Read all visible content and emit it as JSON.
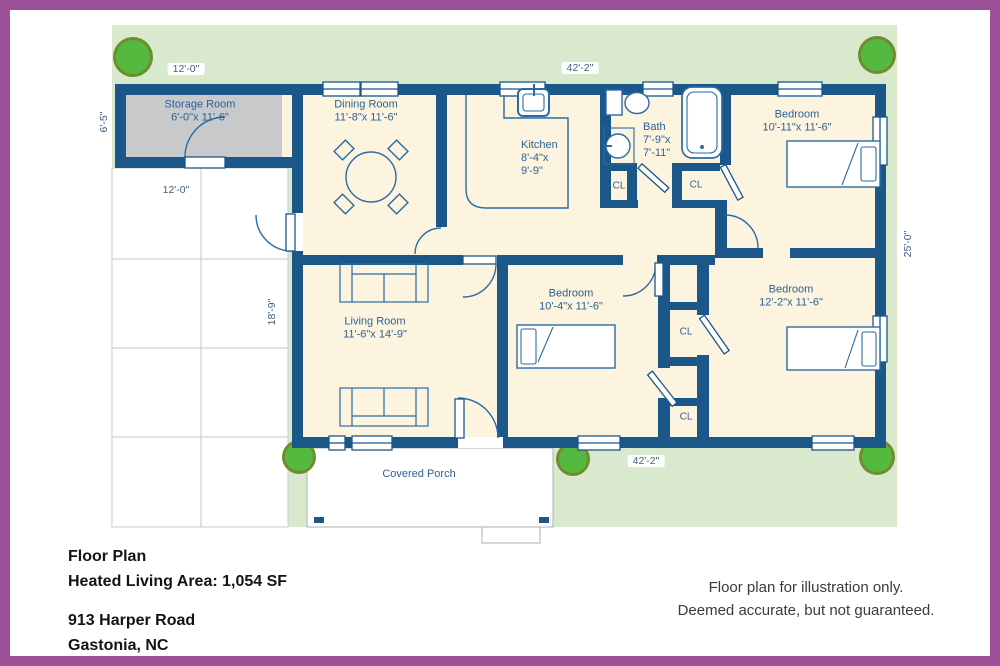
{
  "rooms": {
    "storage": {
      "name": "Storage Room",
      "dims": "6'-0\"x 11'-6\""
    },
    "dining": {
      "name": "Dining Room",
      "dims": "11'-8\"x 11'-6\""
    },
    "kitchen": {
      "name": "Kitchen",
      "dims_line1": "8'-4\"x",
      "dims_line2": "9'-9\""
    },
    "bath": {
      "name": "Bath",
      "dims_line1": "7'-9\"x",
      "dims_line2": "7'-11\""
    },
    "bedroom1": {
      "name": "Bedroom",
      "dims": "10'-11\"x 11'-6\""
    },
    "bedroom2": {
      "name": "Bedroom",
      "dims": "10'-4\"x 11'-6\""
    },
    "bedroom3": {
      "name": "Bedroom",
      "dims": "12'-2\"x 11'-6\""
    },
    "living": {
      "name": "Living Room",
      "dims": "11'-6\"x 14'-9\""
    },
    "porch": {
      "name": "Covered Porch"
    }
  },
  "closets": [
    "CL",
    "CL",
    "CL",
    "CL"
  ],
  "dimensions": {
    "storage_width": "12'-0\"",
    "storage_depth": "6'-5\"",
    "width_top": "42'-2\"",
    "width_bottom": "42'-2\"",
    "depth_right": "25'-0\"",
    "driveway": "12'-0\"",
    "living_side": "18'-9\""
  },
  "title_block": {
    "heading": "Floor Plan",
    "area": "Heated Living Area: 1,054 SF",
    "address1": "913 Harper Road",
    "address2": "Gastonia, NC"
  },
  "disclaimer": {
    "line1": "Floor plan for illustration only.",
    "line2": "Deemed accurate, but not guaranteed."
  },
  "colors": {
    "border_purple": "#9c5198",
    "wall_blue": "#1b5789",
    "floor_cream": "#fcf4de",
    "lawn_green": "#d9e9cd",
    "storage_grey": "#c7c9cb",
    "tree_green": "#55b93f"
  }
}
